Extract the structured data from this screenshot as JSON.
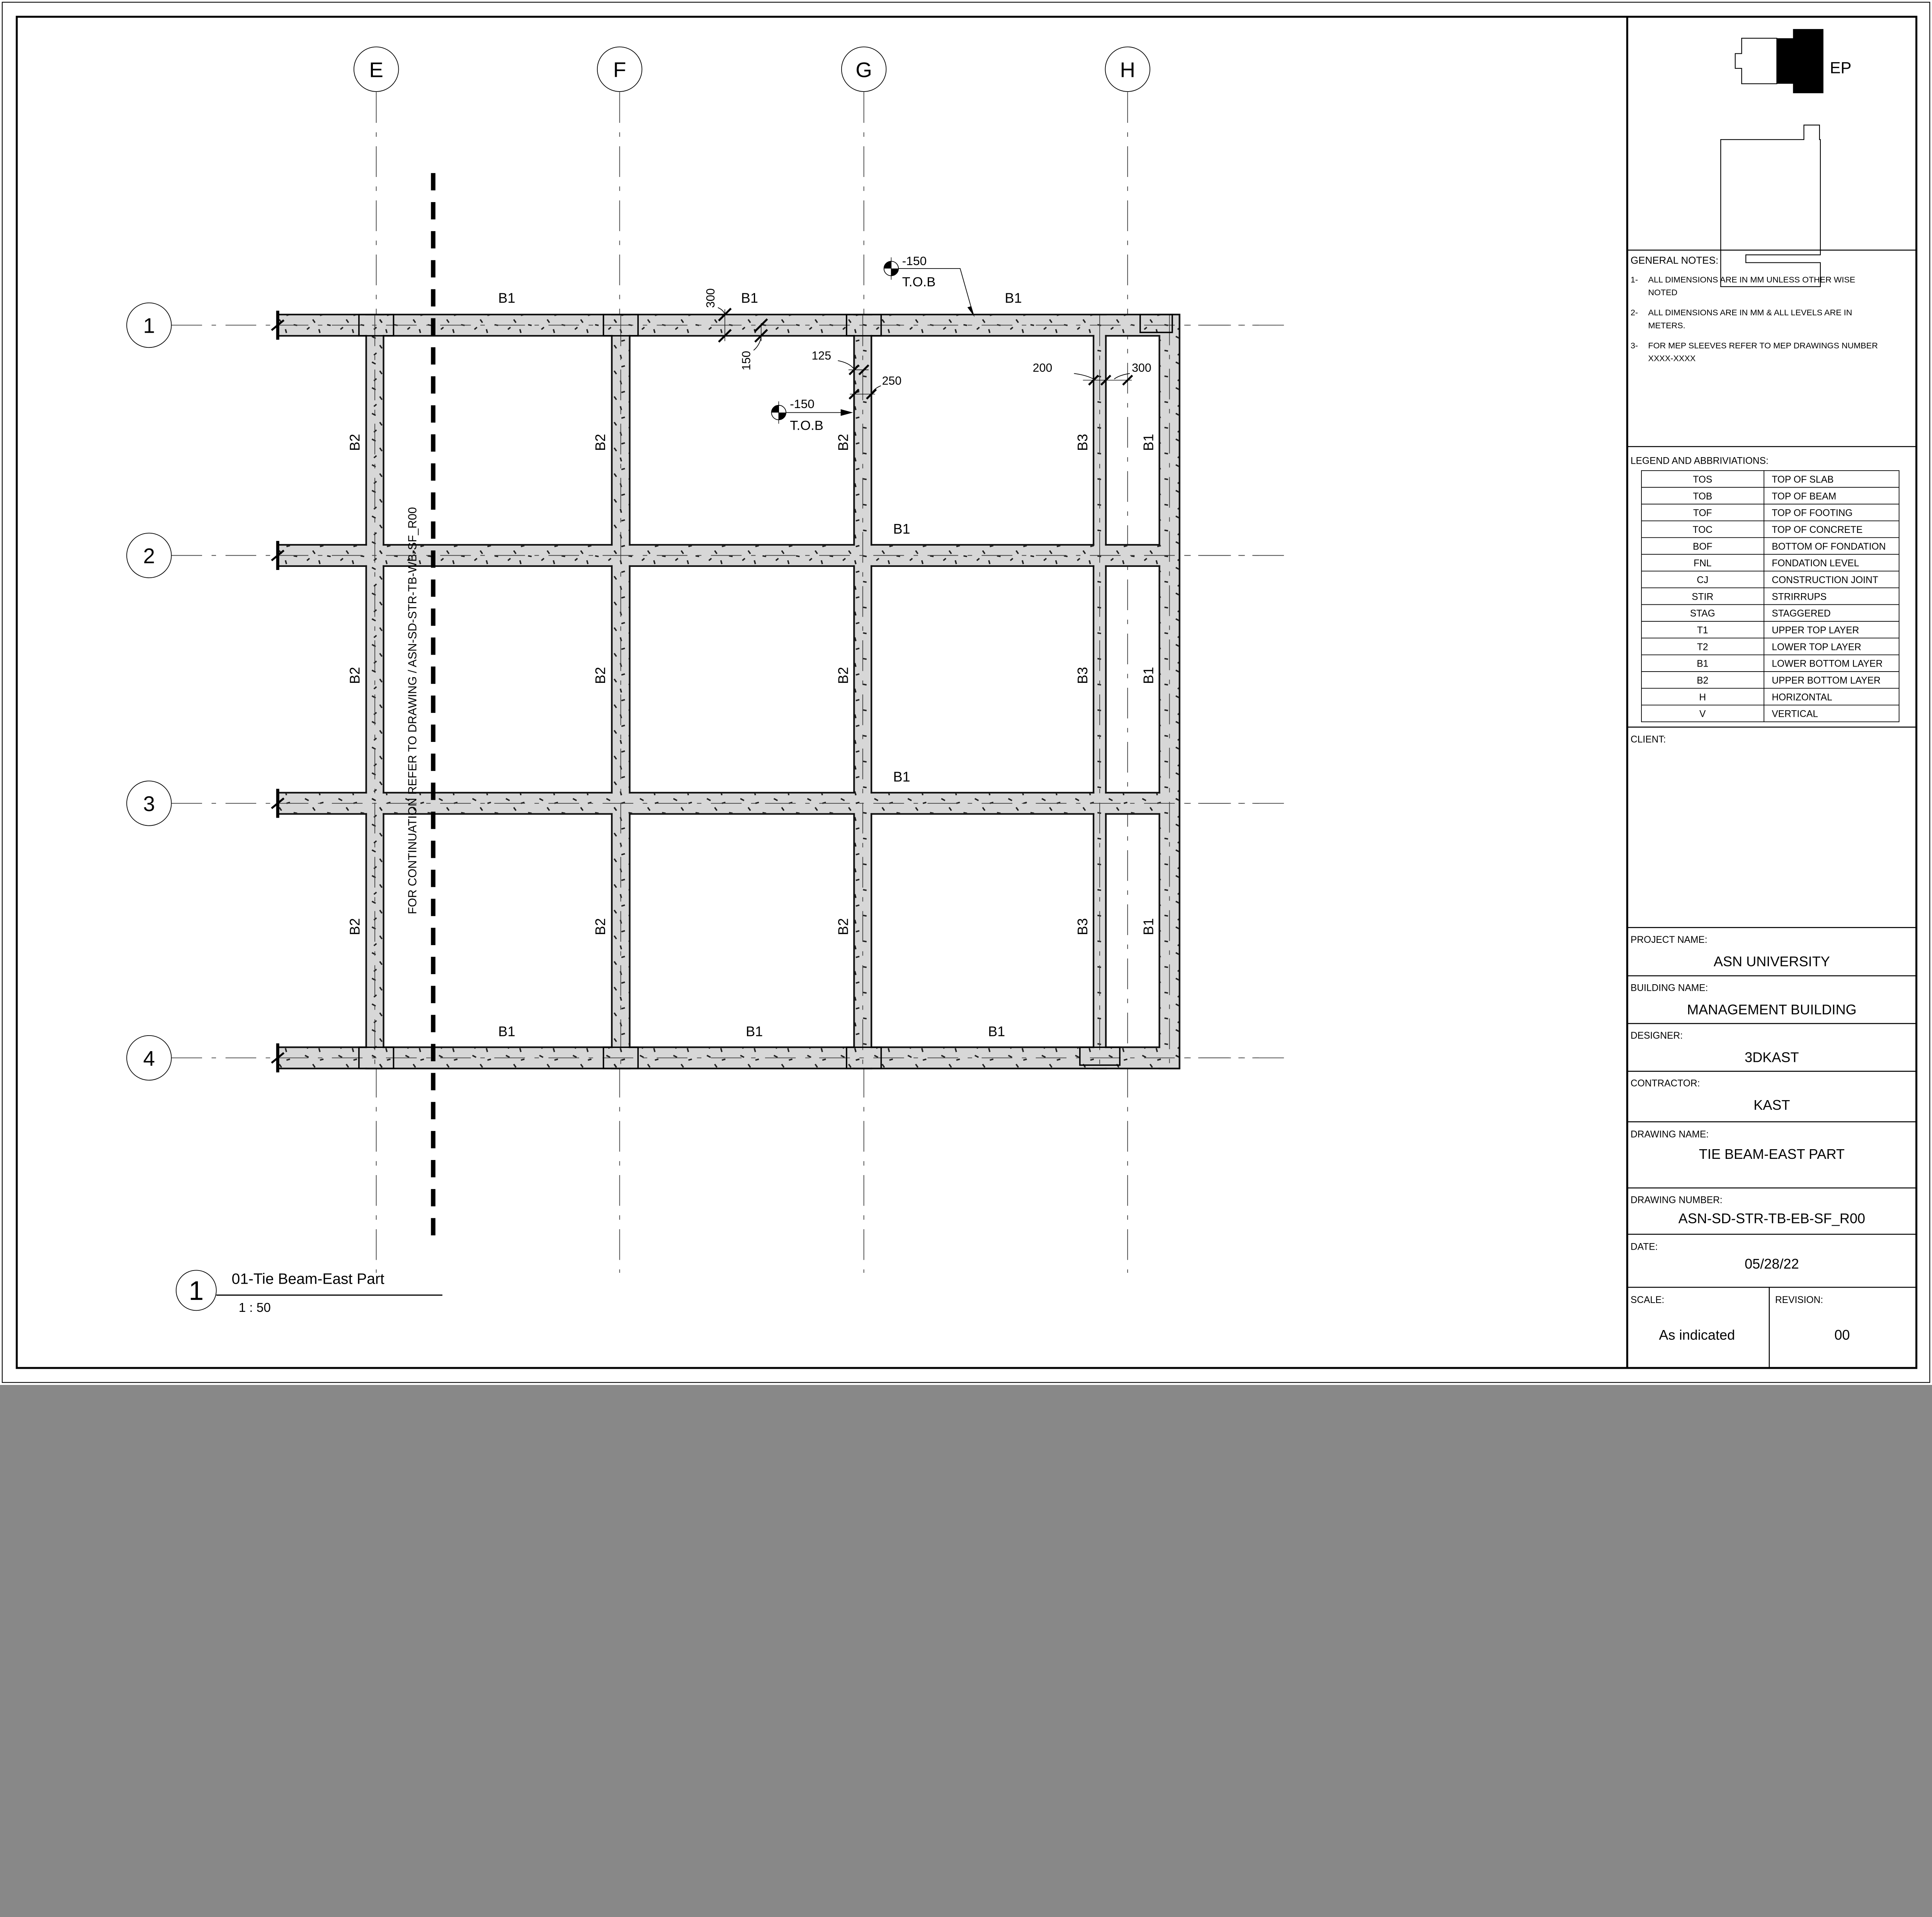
{
  "logo": {
    "text": "EP"
  },
  "general_notes": {
    "title": "GENERAL NOTES:",
    "items": [
      {
        "num": "1-",
        "line1": "ALL DIMENSIONS ARE IN MM UNLESS OTHER WISE",
        "line2": "NOTED"
      },
      {
        "num": "2-",
        "line1": "ALL DIMENSIONS ARE IN MM & ALL LEVELS ARE IN",
        "line2": "METERS."
      },
      {
        "num": "3-",
        "line1": "FOR MEP SLEEVES REFER TO MEP DRAWINGS NUMBER",
        "line2": "XXXX-XXXX"
      }
    ]
  },
  "legend": {
    "title": "LEGEND AND ABBRIVIATIONS:",
    "rows": [
      {
        "abbr": "TOS",
        "desc": "TOP OF SLAB"
      },
      {
        "abbr": "TOB",
        "desc": "TOP OF BEAM"
      },
      {
        "abbr": "TOF",
        "desc": "TOP OF FOOTING"
      },
      {
        "abbr": "TOC",
        "desc": "TOP OF CONCRETE"
      },
      {
        "abbr": "BOF",
        "desc": "BOTTOM OF FONDATION"
      },
      {
        "abbr": "FNL",
        "desc": "FONDATION LEVEL"
      },
      {
        "abbr": "CJ",
        "desc": "CONSTRUCTION JOINT"
      },
      {
        "abbr": "STIR",
        "desc": "STRIRRUPS"
      },
      {
        "abbr": "STAG",
        "desc": "STAGGERED"
      },
      {
        "abbr": "T1",
        "desc": "UPPER TOP LAYER"
      },
      {
        "abbr": "T2",
        "desc": "LOWER TOP LAYER"
      },
      {
        "abbr": "B1",
        "desc": "LOWER BOTTOM LAYER"
      },
      {
        "abbr": "B2",
        "desc": "UPPER BOTTOM LAYER"
      },
      {
        "abbr": "H",
        "desc": "HORIZONTAL"
      },
      {
        "abbr": "V",
        "desc": "VERTICAL"
      }
    ]
  },
  "title_block": {
    "client_label": "CLIENT:",
    "project_label": "PROJECT NAME:",
    "project": "ASN UNIVERSITY",
    "building_label": "BUILDING NAME:",
    "building": "MANAGEMENT BUILDING",
    "designer_label": "DESIGNER:",
    "designer": "3DKAST",
    "contractor_label": "CONTRACTOR:",
    "contractor": "KAST",
    "drawing_name_label": "DRAWING NAME:",
    "drawing_name": "TIE BEAM-EAST PART",
    "drawing_number_label": "DRAWING NUMBER:",
    "drawing_number": "ASN-SD-STR-TB-EB-SF_R00",
    "date_label": "DATE:",
    "date": "05/28/22",
    "scale_label": "SCALE:",
    "scale": "As indicated",
    "revision_label": "REVISION:",
    "revision": "00"
  },
  "plan": {
    "grid_cols": [
      "E",
      "F",
      "G",
      "H"
    ],
    "grid_rows": [
      "1",
      "2",
      "3",
      "4"
    ],
    "continuation_note": "FOR CONTINUATION REFER TO DRAWING / ASN-SD-STR-TB-WB-SF_R00",
    "row_beam_labels": [
      "B1",
      "B1",
      "B1",
      "B1",
      "B1",
      "B1",
      "B1",
      "B1"
    ],
    "vertical_beam_labels": [
      "B2",
      "B2",
      "B2",
      "B3",
      "B1",
      "B2",
      "B2",
      "B2",
      "B3",
      "B1",
      "B2",
      "B2",
      "B2",
      "B3",
      "B1"
    ],
    "levels": [
      {
        "value": "-150",
        "ref": "T.O.B"
      },
      {
        "value": "-150",
        "ref": "T.O.B"
      }
    ],
    "dims": [
      "300",
      "150",
      "125",
      "250",
      "200",
      "300"
    ],
    "view": {
      "number": "1",
      "title": "01-Tie Beam-East Part",
      "scale": "1 : 50"
    }
  }
}
